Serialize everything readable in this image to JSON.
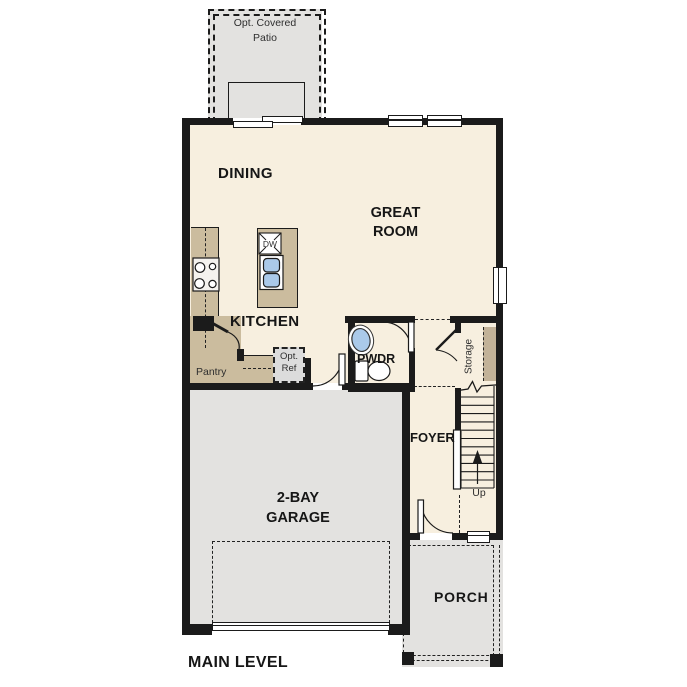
{
  "palette": {
    "wall": "#1b1b1b",
    "floor": "#f7efdf",
    "concrete_gray": "#e3e2e0",
    "cabinet_tan": "#cbbc9e",
    "shelf_tan": "#c2b298",
    "fixture_blue": "#aac9e9",
    "optional_item_gray": "#dcdcdc"
  },
  "plan": {
    "title": "MAIN LEVEL",
    "rooms": {
      "patio": {
        "line1": "Opt. Covered",
        "line2": "Patio"
      },
      "dining": {
        "label": "DINING"
      },
      "great_room": {
        "line1": "GREAT",
        "line2": "ROOM"
      },
      "kitchen": {
        "label": "KITCHEN"
      },
      "pantry": {
        "label": "Pantry"
      },
      "pwdr": {
        "label": "PWDR"
      },
      "storage": {
        "label": "Storage"
      },
      "foyer": {
        "label": "FOYER"
      },
      "garage": {
        "line1": "2-BAY",
        "line2": "GARAGE"
      },
      "porch": {
        "label": "PORCH"
      }
    },
    "fixtures": {
      "dishwasher": "DW",
      "opt_ref_line1": "Opt.",
      "opt_ref_line2": "Ref",
      "stairs_up": "Up"
    }
  }
}
